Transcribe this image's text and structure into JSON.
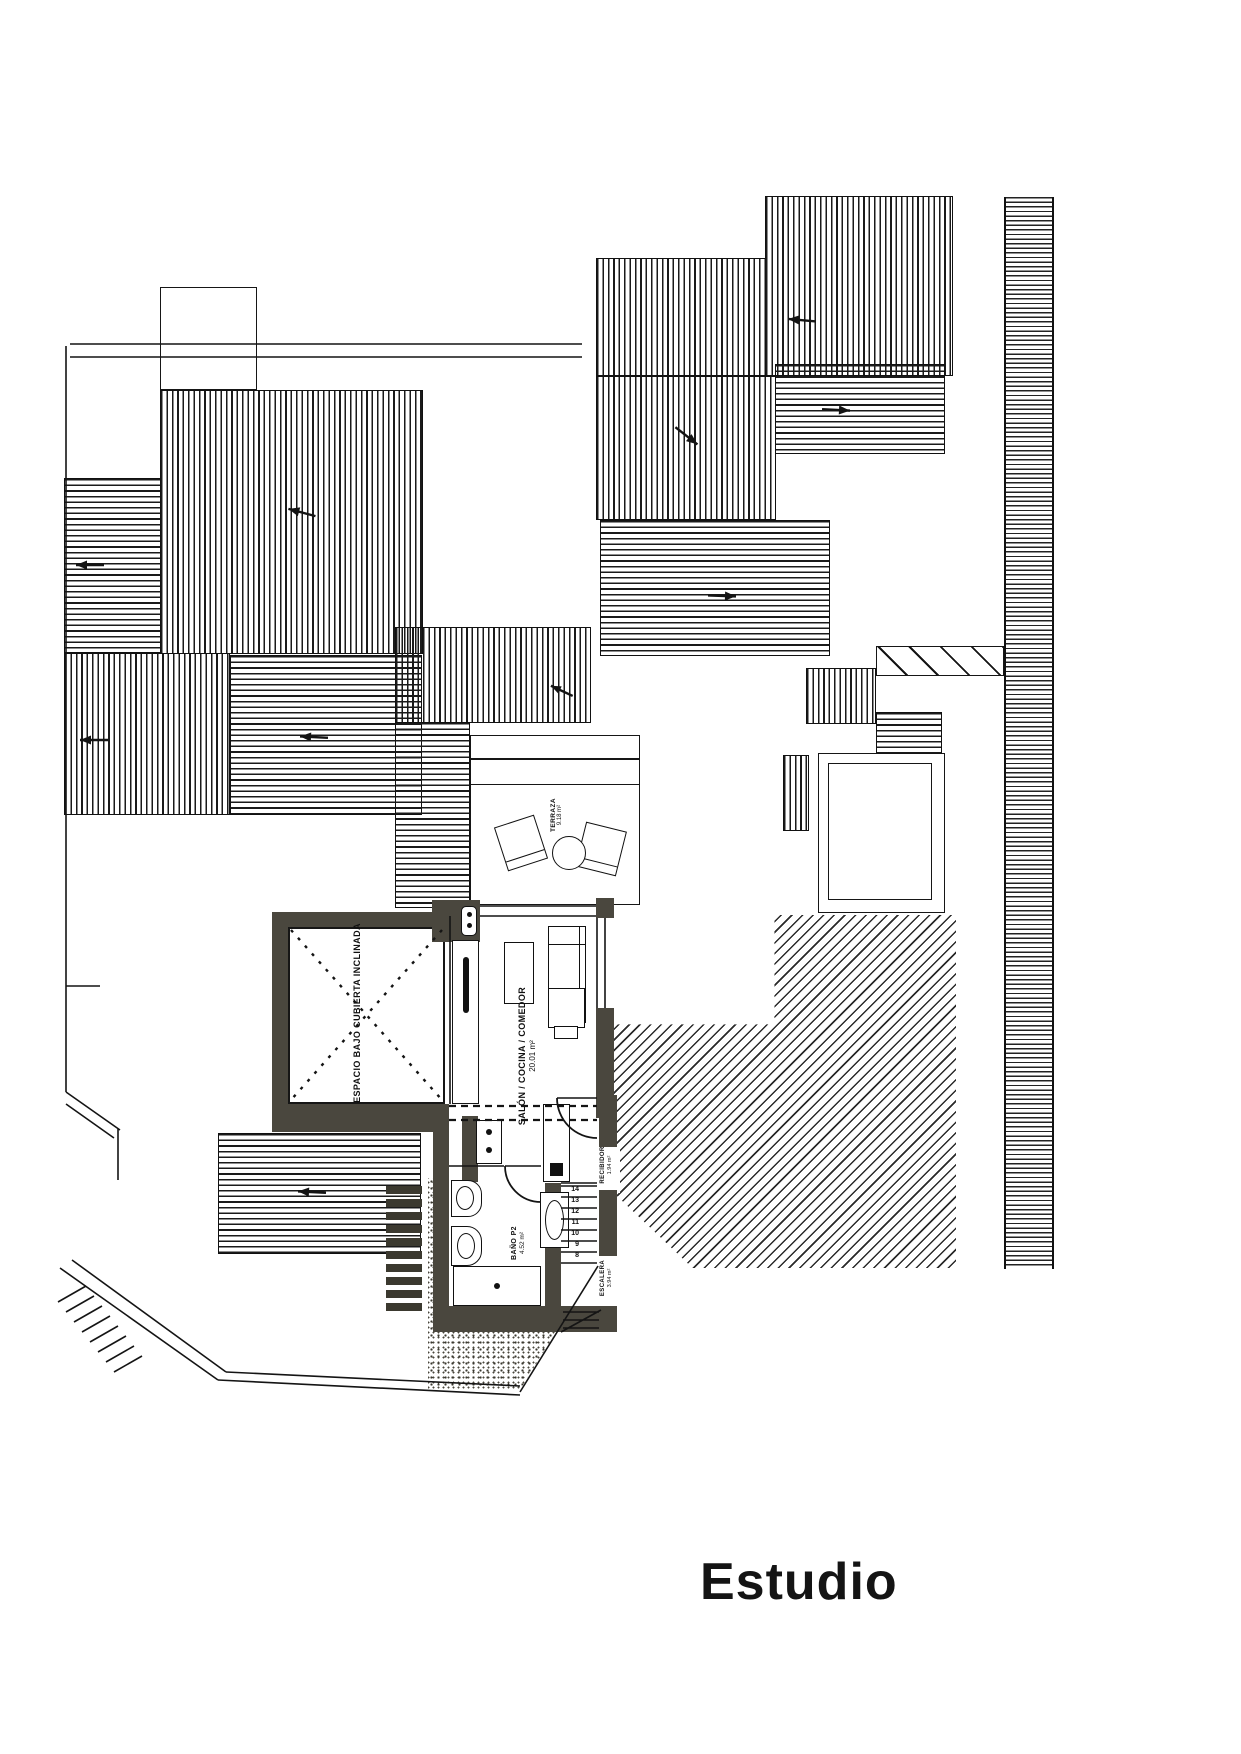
{
  "title": "Estudio",
  "plan": {
    "rooms": {
      "espacio": {
        "label": "ESPACIO BAJO CUBIERTA INCLINADA"
      },
      "salon": {
        "label": "SALÓN / COCINA / COMEDOR",
        "area": "20.01 m²"
      },
      "terraza": {
        "label": "TERRAZA",
        "area": "9.18 m²"
      },
      "bano": {
        "label": "BAÑO P2",
        "area": "4.52 m²"
      },
      "recibidor": {
        "label": "RECIBIDOR",
        "area": "1.94 m²"
      },
      "escalera": {
        "label": "ESCALERA",
        "area": "3.94 m²"
      }
    },
    "stairs": {
      "numbers": [
        "14",
        "13",
        "12",
        "11",
        "10",
        "9",
        "8"
      ]
    }
  },
  "colors": {
    "wall": "#4a473e",
    "line": "#141414",
    "paper": "#ffffff"
  }
}
